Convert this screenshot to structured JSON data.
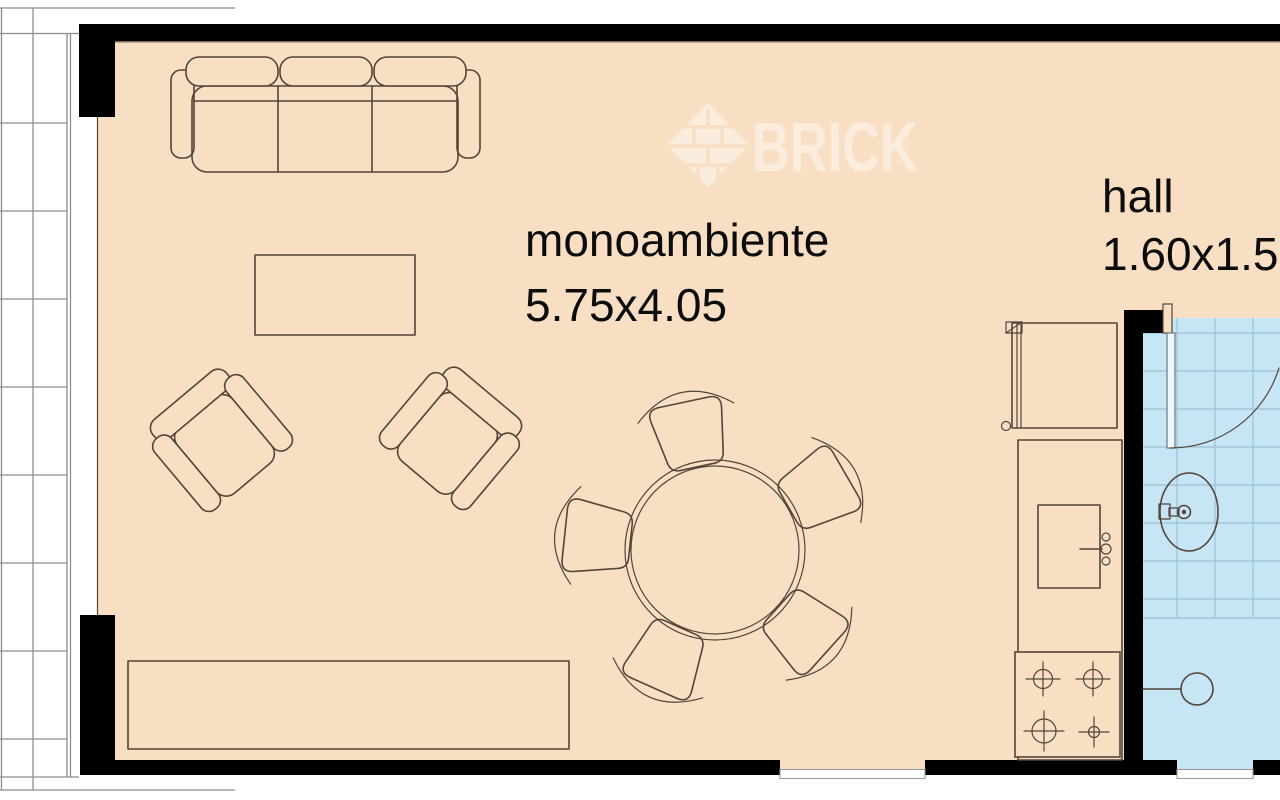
{
  "watermark": {
    "brand": "BRICK",
    "logo": "brick-diamond-logo"
  },
  "rooms": {
    "main": {
      "name": "monoambiente",
      "dimensions": "5.75x4.05"
    },
    "hall": {
      "name": "hall",
      "dimensions": "1.60x1.5"
    }
  },
  "furniture": {
    "living": [
      "sofa-3-seat",
      "coffee-table",
      "armchair-left",
      "armchair-right",
      "sideboard"
    ],
    "dining": {
      "table": "round-table",
      "chairs": 5
    },
    "kitchen": [
      "refrigerator",
      "counter",
      "sink",
      "stove-4-burners"
    ],
    "bathroom": [
      "swing-door",
      "washbasin",
      "shower-drain",
      "window"
    ],
    "exterior": [
      "balcony-tiles",
      "window-bottom"
    ]
  },
  "colors": {
    "floor": "#f8dfc3",
    "bath": "#c6e5f5",
    "wall": "#000000",
    "outline": "#54443a",
    "balcony_line": "#8d8d8d",
    "tile_line": "#9dc1d4",
    "watermark": "rgba(255,255,255,0.45)",
    "label": "#0c0c0c"
  }
}
